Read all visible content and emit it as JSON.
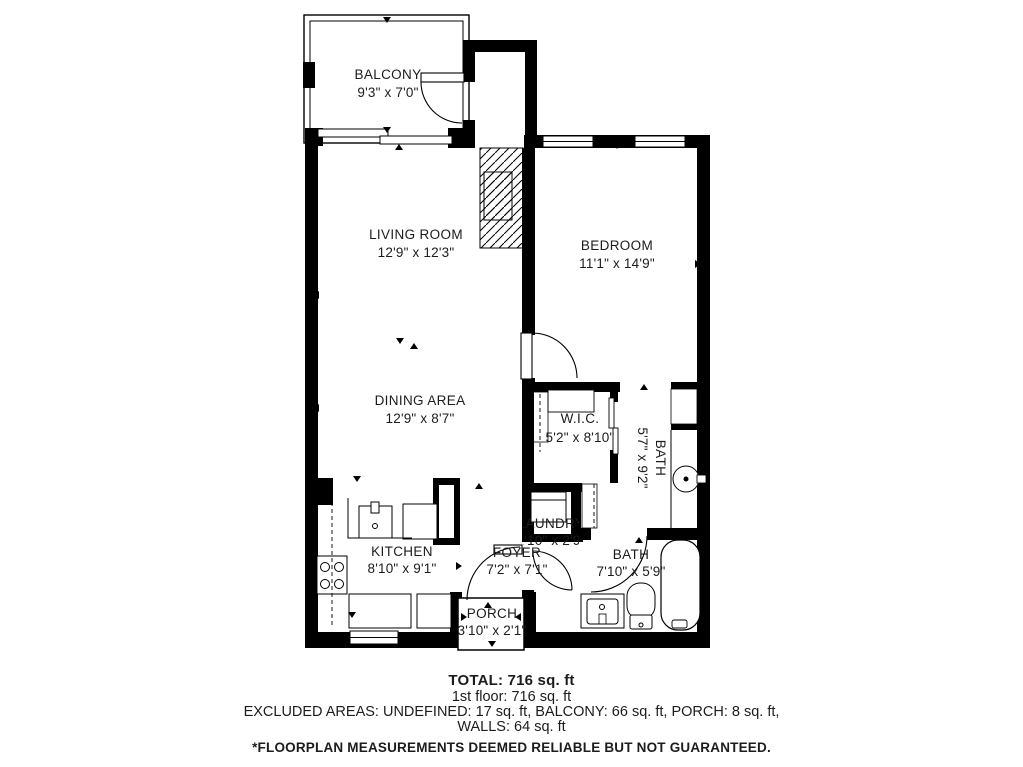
{
  "floorplan": {
    "rooms": {
      "balcony": {
        "name": "BALCONY",
        "dims": "9'3\" x 7'0\""
      },
      "living_room": {
        "name": "LIVING ROOM",
        "dims": "12'9\" x 12'3\""
      },
      "bedroom": {
        "name": "BEDROOM",
        "dims": "11'1\" x 14'9\""
      },
      "dining_area": {
        "name": "DINING AREA",
        "dims": "12'9\" x 8'7\""
      },
      "wic": {
        "name": "W.I.C.",
        "dims": "5'2\" x 8'10\""
      },
      "bath_ensuite": {
        "name": "BATH",
        "dims": "5'7\" x 9'2\""
      },
      "laundry": {
        "name": "LAUNDRY",
        "dims": "2'10\" x 2'9\""
      },
      "kitchen": {
        "name": "KITCHEN",
        "dims": "8'10\" x 9'1\""
      },
      "foyer": {
        "name": "FOYER",
        "dims": "7'2\" x 7'1\""
      },
      "bath_main": {
        "name": "BATH",
        "dims": "7'10\" x 5'9\""
      },
      "porch": {
        "name": "PORCH",
        "dims": "3'10\" x 2'1\""
      }
    },
    "summary": {
      "total": "TOTAL: 716 sq. ft",
      "floor1": "1st floor: 716 sq. ft",
      "excluded": "EXCLUDED AREAS: UNDEFINED: 17 sq. ft, BALCONY: 66 sq. ft, PORCH: 8 sq. ft,",
      "walls": "WALLS: 64 sq. ft",
      "disclaimer": "*FLOORPLAN MEASUREMENTS DEEMED RELIABLE BUT NOT GUARANTEED."
    },
    "colors": {
      "wall": "#000000",
      "background": "#ffffff",
      "text": "#1c1c1c"
    }
  }
}
